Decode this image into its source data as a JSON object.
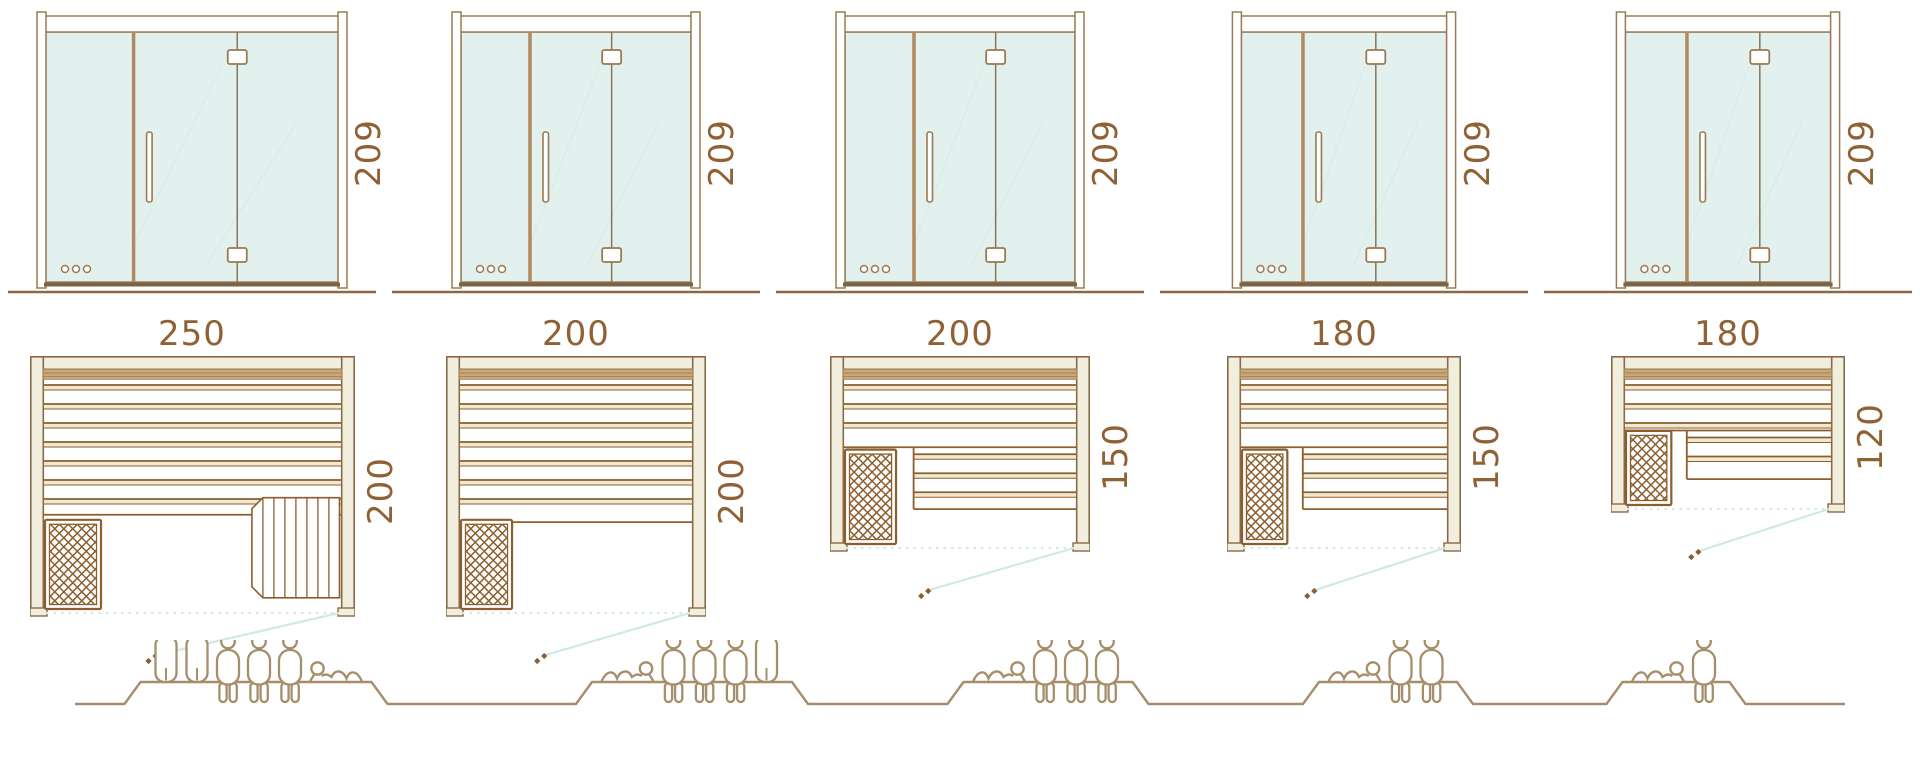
{
  "colors": {
    "frame_outline": "#8a6a46",
    "frame_fill": "#f2eedd",
    "glass_fill": "#e3f1ee",
    "glass_line": "#85755a",
    "glass_reflection": "#d9ece8",
    "wood_line": "#8d5e2d",
    "wood_band": "#c9a87b",
    "wood_band_line": "#a7855c",
    "post_line": "#9a7a52",
    "door_edge": "#b08a5e",
    "sill": "#7e6342",
    "dimension_text": "#8f6134",
    "people_line": "#a68e6b",
    "teal_line": "#cfe9e5",
    "white": "#ffffff"
  },
  "saunas": [
    {
      "id": "250x200",
      "width_label": "250",
      "depth_label": "200",
      "height_label": "209",
      "width_cm": 250,
      "depth_cm": 200,
      "height_cm": 209,
      "capacity": 6,
      "people": [
        "standing",
        "standing",
        "seated",
        "seated",
        "seated",
        "lying-left"
      ],
      "layout": "two-benches-with-step"
    },
    {
      "id": "200x200",
      "width_label": "200",
      "depth_label": "200",
      "height_label": "209",
      "width_cm": 200,
      "depth_cm": 200,
      "height_cm": 209,
      "capacity": 5,
      "people": [
        "lying-right",
        "seated",
        "seated",
        "seated",
        "standing"
      ],
      "layout": "single-wide-bench"
    },
    {
      "id": "200x150",
      "width_label": "200",
      "depth_label": "150",
      "height_label": "209",
      "width_cm": 200,
      "depth_cm": 150,
      "height_cm": 209,
      "capacity": 4,
      "people": [
        "lying-right",
        "seated",
        "seated",
        "seated"
      ],
      "layout": "l-shaped-bench"
    },
    {
      "id": "180x150",
      "width_label": "180",
      "depth_label": "150",
      "height_label": "209",
      "width_cm": 180,
      "depth_cm": 150,
      "height_cm": 209,
      "capacity": 3,
      "people": [
        "lying-right",
        "seated",
        "seated"
      ],
      "layout": "l-shaped-bench"
    },
    {
      "id": "180x120",
      "width_label": "180",
      "depth_label": "120",
      "height_label": "209",
      "width_cm": 180,
      "depth_cm": 120,
      "height_cm": 209,
      "capacity": 2,
      "people": [
        "lying-right",
        "seated"
      ],
      "layout": "l-shaped-bench"
    }
  ]
}
